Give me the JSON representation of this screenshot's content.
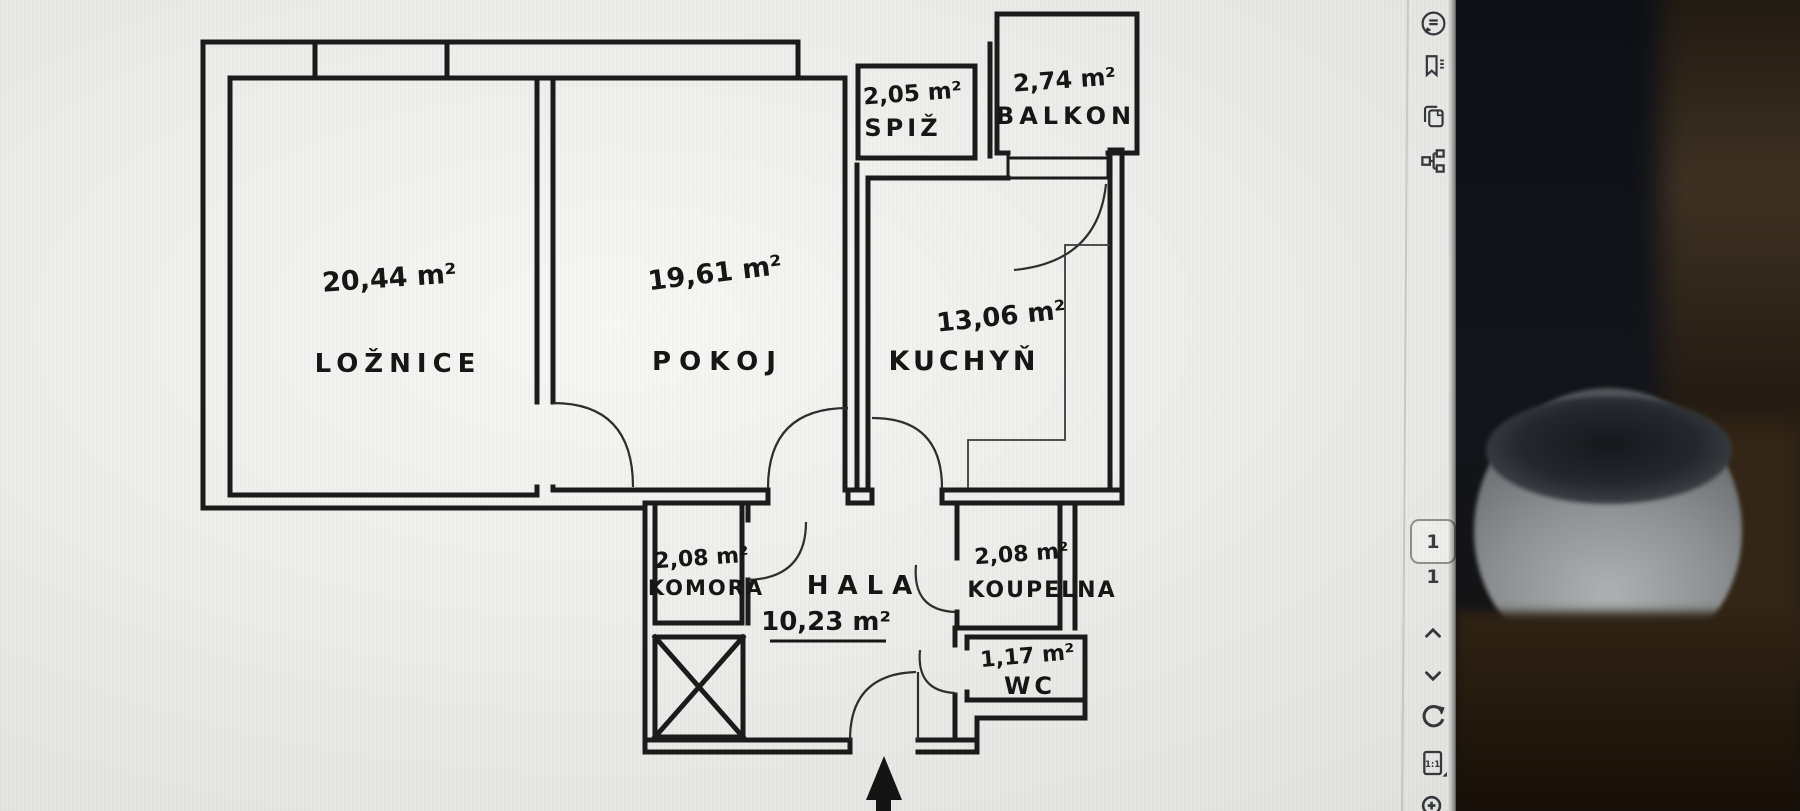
{
  "toolbar": {
    "page_number": "1",
    "page_count": "1",
    "actual_size_label": "1:1",
    "icons": [
      "comment",
      "bookmark",
      "copy",
      "structure",
      "chevron-up",
      "chevron-down",
      "rotate",
      "actual-size",
      "zoom-in"
    ]
  },
  "floorplan": {
    "rooms": [
      {
        "id": "loznice",
        "name": "LOŽNICE",
        "area": "20,44 m²"
      },
      {
        "id": "pokoj",
        "name": "POKOJ",
        "area": "19,61 m²"
      },
      {
        "id": "kuchyn",
        "name": "KUCHYŇ",
        "area": "13,06 m²"
      },
      {
        "id": "spiz",
        "name": "SPIŽ",
        "area": "2,05 m²"
      },
      {
        "id": "balkon",
        "name": "BALKON",
        "area": "2,74 m²"
      },
      {
        "id": "komora",
        "name": "KOMORA",
        "area": "2,08 m²"
      },
      {
        "id": "hala",
        "name": "HALA",
        "area": "10,23 m²"
      },
      {
        "id": "koupelna",
        "name": "KOUPELNA",
        "area": "2,08 m²"
      },
      {
        "id": "wc",
        "name": "WC",
        "area": "1,17 m²"
      }
    ]
  },
  "colors": {
    "ink": "#1b1b1b",
    "screen_bg": "#e9eae5",
    "icon": "#35383b",
    "photo_dark": "#12151a",
    "desk_brown": "#32251a",
    "bowl_gray": "#8b8f91"
  }
}
